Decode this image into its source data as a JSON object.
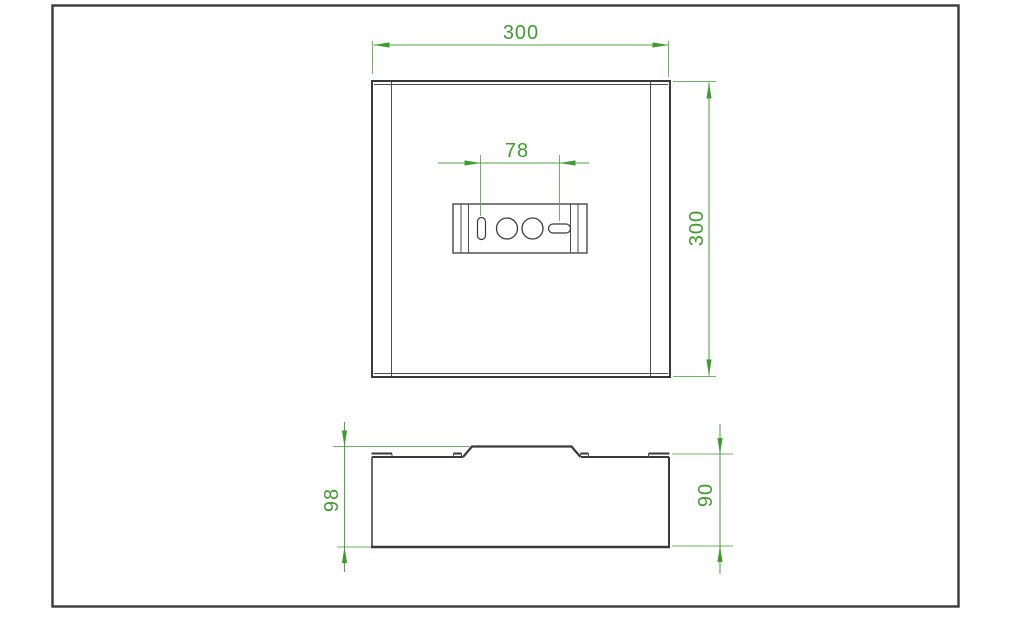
{
  "colors": {
    "background": "#ffffff",
    "line": "#3a3a3a",
    "line_thin": "#4d4d4d",
    "dimension": "#3f9c2e",
    "dimension_ext": "#4aa338"
  },
  "sheet": {
    "frame": {
      "x": 52.5,
      "y": 5.5,
      "width": 906,
      "height": 601,
      "stroke_width": 2.4
    }
  },
  "top_view": {
    "outline": {
      "x": 372,
      "y": 81,
      "width": 298,
      "height": 296
    },
    "top_inner_line": {
      "x1": 374,
      "y1": 84.5,
      "x2": 668,
      "y2": 84.5
    },
    "bottom_inner_line": {
      "x1": 374,
      "y1": 373.5,
      "x2": 668,
      "y2": 373.5
    },
    "flange_lines": [
      {
        "x1": 391.5,
        "y1": 82,
        "x2": 391.5,
        "y2": 376
      },
      {
        "x1": 650.5,
        "y1": 82,
        "x2": 650.5,
        "y2": 376
      }
    ],
    "junction_plate": {
      "rect": {
        "x": 453,
        "y": 204,
        "width": 134,
        "height": 49
      },
      "inner_lines_x": [
        461,
        468.5,
        570.5,
        578
      ],
      "vertical_slot": {
        "x": 477.5,
        "y": 217.5,
        "width": 8,
        "height": 22,
        "rx": 4
      },
      "holes": [
        {
          "cx": 507,
          "cy": 228.5,
          "r": 10.5
        },
        {
          "cx": 532.5,
          "cy": 228.5,
          "r": 10.5
        }
      ],
      "horizontal_slot": {
        "x": 548.5,
        "y": 224,
        "width": 22,
        "height": 9,
        "rx": 4.5
      }
    }
  },
  "front_view": {
    "body": {
      "x": 372,
      "y": 457,
      "width": 297,
      "height": 90
    },
    "top_edge_y": 457,
    "top_edge_segments": [
      {
        "x1": 372,
        "x2": 463
      },
      {
        "x1": 581,
        "x2": 669
      }
    ],
    "bump": {
      "points": "463,457 472,446.5 571.5,446.5 580.5,457"
    },
    "tabs": [
      {
        "x1": 371.5,
        "x2": 392,
        "y": 453.5,
        "drops": [
          392
        ]
      },
      {
        "x1": 453.5,
        "x2": 461.5,
        "y": 453.5,
        "drops": [
          453.5,
          461.5
        ]
      },
      {
        "x1": 580.5,
        "x2": 588.5,
        "y": 453.5,
        "drops": [
          580.5,
          588.5
        ]
      },
      {
        "x1": 648.5,
        "x2": 669.5,
        "y": 453.5,
        "drops": [
          648.5
        ]
      }
    ]
  },
  "dimensions": [
    {
      "id": "overall-width",
      "label": "300",
      "line": {
        "x1": 373.5,
        "y1": 45,
        "x2": 668.5,
        "y2": 45
      },
      "arrows": [
        {
          "x": 373.5,
          "y": 45,
          "dir": "left"
        },
        {
          "x": 668.5,
          "y": 45,
          "dir": "right"
        }
      ],
      "extensions": [
        {
          "x1": 372.5,
          "y1": 41,
          "x2": 372.5,
          "y2": 74
        },
        {
          "x1": 668.5,
          "y1": 41,
          "x2": 668.5,
          "y2": 77
        }
      ],
      "text": {
        "x": 521,
        "y": 39,
        "rotate": 0
      }
    },
    {
      "id": "overall-height",
      "label": "300",
      "line": {
        "x1": 709,
        "y1": 82.5,
        "x2": 709,
        "y2": 375.5
      },
      "arrows": [
        {
          "x": 709,
          "y": 82.5,
          "dir": "up"
        },
        {
          "x": 709,
          "y": 375.5,
          "dir": "down"
        }
      ],
      "extensions": [
        {
          "x1": 673,
          "y1": 81.5,
          "x2": 716,
          "y2": 81.5
        },
        {
          "x1": 673,
          "y1": 376.5,
          "x2": 716,
          "y2": 376.5
        }
      ],
      "text": {
        "x": 703,
        "y": 228,
        "rotate": -90
      }
    },
    {
      "id": "slot-spacing",
      "label": "78",
      "line": {
        "x1": 438,
        "y1": 163,
        "x2": 589,
        "y2": 163
      },
      "arrows": [
        {
          "x": 480.5,
          "y": 163,
          "dir": "right"
        },
        {
          "x": 559.5,
          "y": 163,
          "dir": "left"
        }
      ],
      "extensions": [
        {
          "x1": 480.5,
          "y1": 155,
          "x2": 480.5,
          "y2": 216
        },
        {
          "x1": 559.5,
          "y1": 155,
          "x2": 559.5,
          "y2": 221
        }
      ],
      "text": {
        "x": 517,
        "y": 157,
        "rotate": 0
      }
    },
    {
      "id": "overall-depth",
      "label": "98",
      "line": {
        "x1": 344.5,
        "y1": 422,
        "x2": 344.5,
        "y2": 572
      },
      "arrows": [
        {
          "x": 344.5,
          "y": 446.5,
          "dir": "down"
        },
        {
          "x": 344.5,
          "y": 547,
          "dir": "up"
        }
      ],
      "extensions": [
        {
          "x1": 333,
          "y1": 446.5,
          "x2": 470,
          "y2": 446.5
        },
        {
          "x1": 337,
          "y1": 547,
          "x2": 371,
          "y2": 547
        }
      ],
      "text": {
        "x": 338,
        "y": 500,
        "rotate": -90
      }
    },
    {
      "id": "body-depth",
      "label": "90",
      "line": {
        "x1": 720,
        "y1": 424,
        "x2": 720,
        "y2": 574
      },
      "arrows": [
        {
          "x": 720,
          "y": 454,
          "dir": "down"
        },
        {
          "x": 720,
          "y": 546,
          "dir": "up"
        }
      ],
      "extensions": [
        {
          "x1": 672,
          "y1": 454,
          "x2": 733,
          "y2": 454
        },
        {
          "x1": 672,
          "y1": 546,
          "x2": 733,
          "y2": 546
        }
      ],
      "text": {
        "x": 712,
        "y": 495,
        "rotate": -90
      }
    }
  ]
}
